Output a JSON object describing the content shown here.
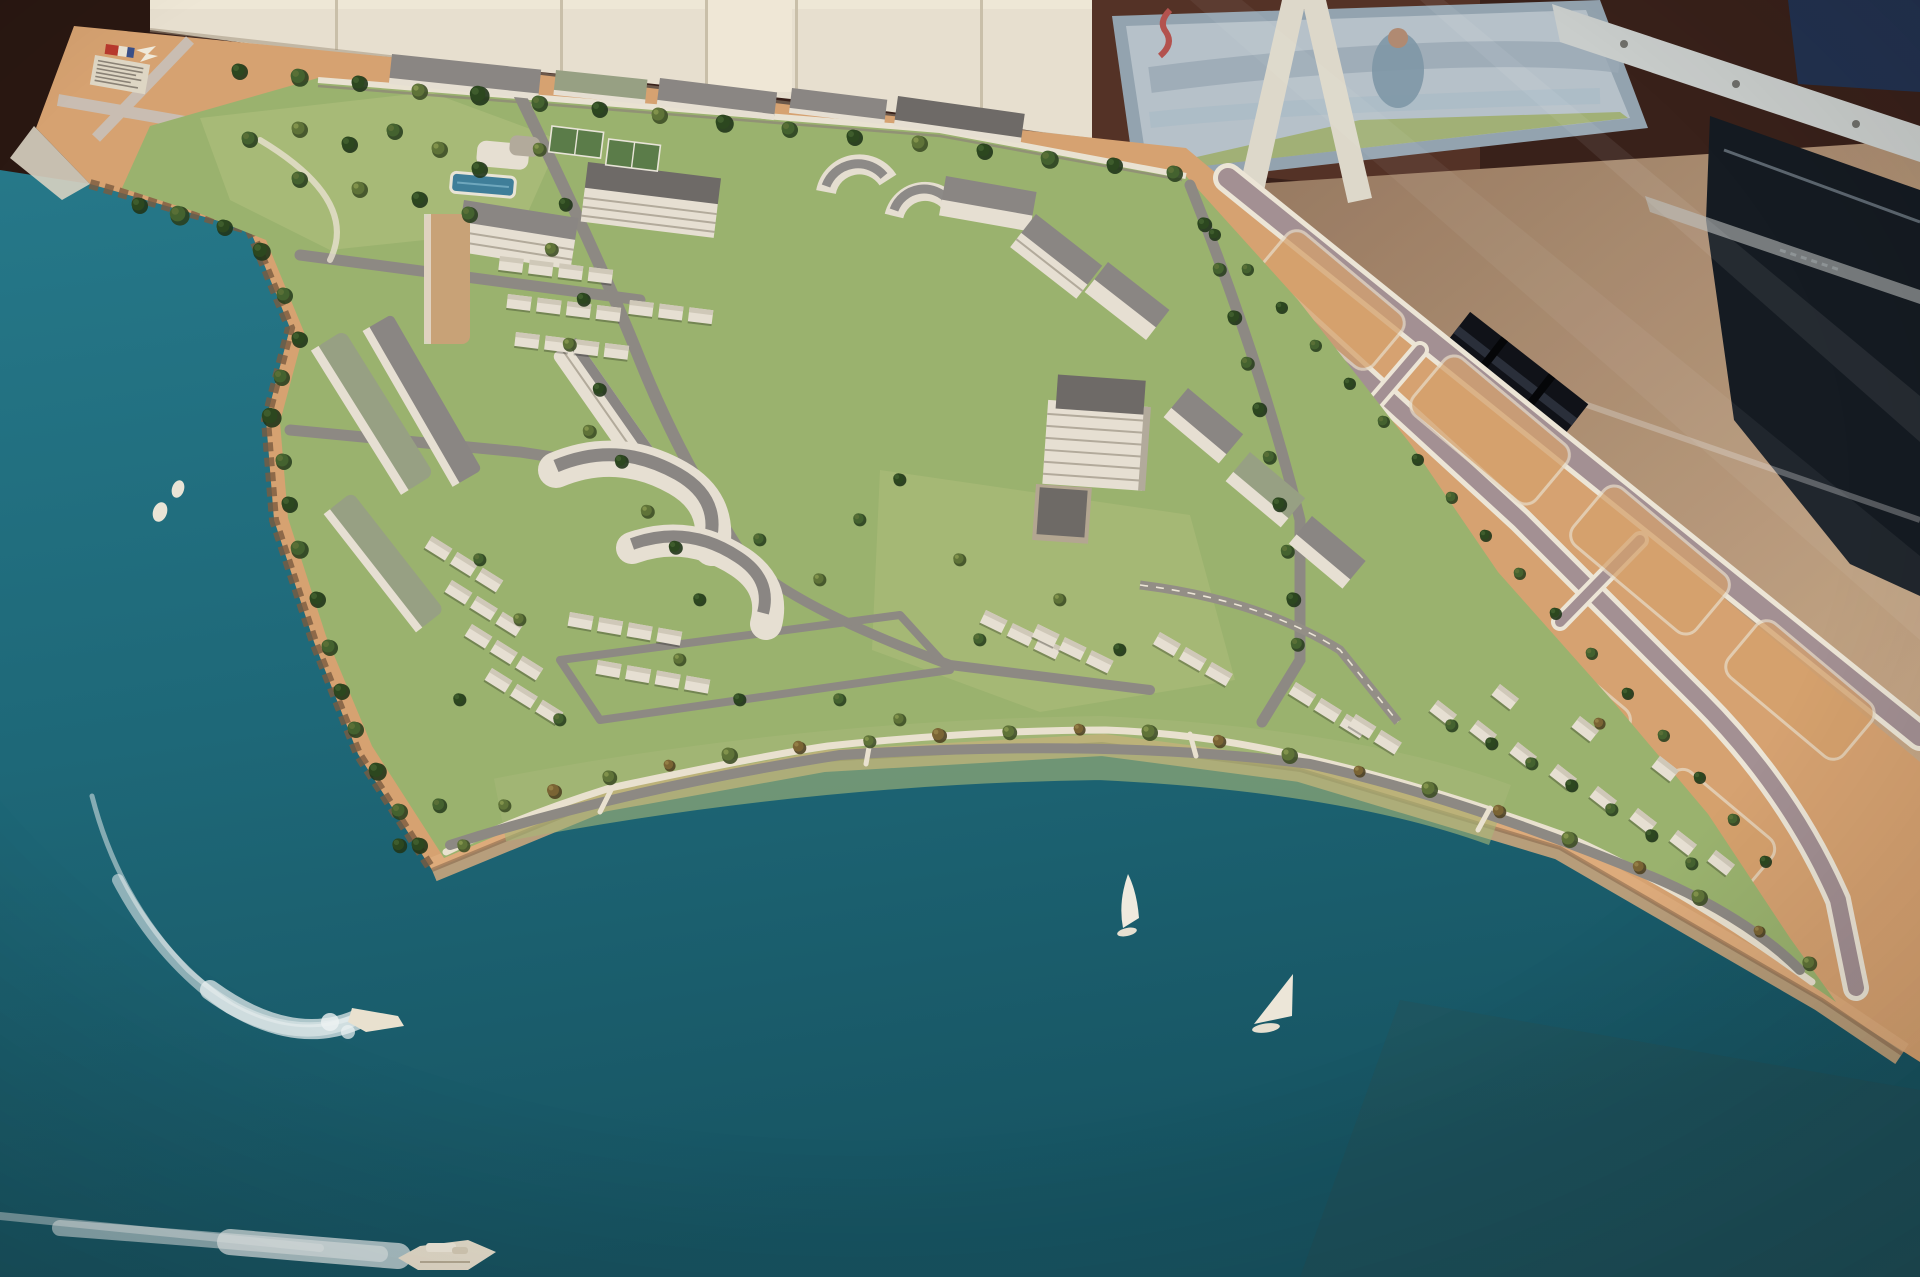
{
  "meta": {
    "description": "Photograph of an architectural scale model of a coastal master-planned community displayed on a glass-covered table. A tan model base holds a green peninsula filled with white apartment blocks, terrace rows, houses, tree-lined streets, tennis courts and a pool. Teal water surrounds it with two sailboats, two dinghies, a speedboat with a curving wake and a motor yacht with a long wake. Behind the model: cream cabinetry, a watercolor poster on an easel, a glass display rail, dark framed displays, a dark crate and tan carpet."
  },
  "counts": {
    "sailboats": 2,
    "dinghies": 2,
    "speedboats": 1,
    "motor_yachts": 1
  },
  "placard": {
    "text_legible": false,
    "line_count": 7
  },
  "colors": {
    "water_top": "#267889",
    "water_mid": "#1e6renew878",
    "water_deep": "#175462",
    "sand": "#d6a271",
    "sand_light": "#e0b184",
    "lot_tan": "#d4a06d",
    "beach_sand": "#dfae7e",
    "grass": "#9ab26e",
    "grass_light": "#a9bb79",
    "grass_dark": "#85a05e",
    "tree_dark": "#2c471f",
    "tree_mid": "#44622f",
    "tree_olive": "#5f7338",
    "tree_rust": "#7a6434",
    "road_gray": "#8d8983",
    "road_mauve": "#a39093",
    "white_line": "#ece5d6",
    "promenade": "#e9e1cf",
    "bldg_white": "#e6dfd2",
    "bldg_shadow": "#b2aa9b",
    "roof_gray": "#8a8683",
    "roof_dark": "#6e6a67",
    "roof_green": "#97a083",
    "roof_tan": "#c8a277",
    "house_wall": "#cfc8b8",
    "pool_blue": "#3f7e99",
    "court_green": "#5b7c49",
    "cabinet": "#e7dfcf",
    "cabinet_shadow": "#c9bfa9",
    "room_dark": "#39211a",
    "room_warm": "#543226",
    "poster_bg": "#b6c1c9",
    "poster_frame": "#93a3af",
    "easel_white": "#ddd8ca",
    "floor_tan": "#a07San85f",
    "floor_light": "#c2a17e",
    "rail_light": "#c9cdcb",
    "navy_frame": "#223250",
    "display_dark": "#151b22",
    "crate_dark": "#101218",
    "crate_slat": "#2a2f3a",
    "wake_white": "#edf2f2",
    "hull_cream": "#e9e1cf",
    "rock_brown": "#7b5b40",
    "sign_paper": "#ded6c4",
    "sign_red": "#b8392e",
    "sign_blue": "#3a4f88"
  }
}
